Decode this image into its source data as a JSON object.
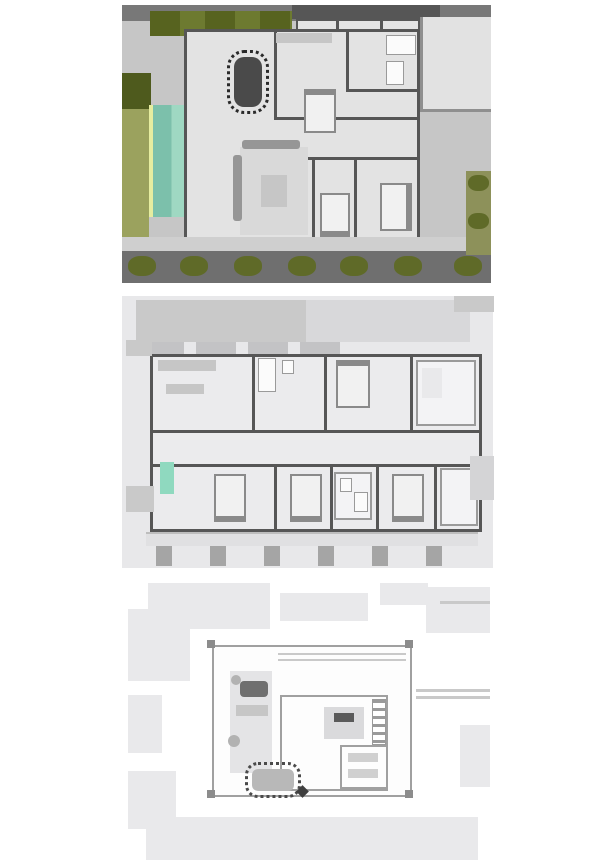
{
  "page": {
    "background": "#ffffff",
    "content_type": "architectural-floor-plan-sheet",
    "text_visible": ""
  },
  "plans": [
    {
      "id": "ground-floor-plan",
      "visible_elements": [
        "site-border-hedges",
        "lawn",
        "swimming-pool",
        "pool-deck",
        "dining-table-with-chairs",
        "kitchen-counter",
        "sofa-and-rug",
        "three-beds",
        "bathroom-fixtures",
        "entry-rooms",
        "driveway-court",
        "walkway",
        "shrub-row"
      ]
    },
    {
      "id": "first-floor-plan",
      "visible_elements": [
        "upper-terrace-band",
        "bedrooms-with-beds",
        "bathrooms",
        "corridor",
        "kitchenette",
        "balcony",
        "balcony-posts",
        "pool-glimpse-below"
      ]
    },
    {
      "id": "roof-plan",
      "visible_elements": [
        "parapet-shapes",
        "roof-terrace",
        "corner-posts",
        "planter-strip",
        "lounge-seating",
        "stair-bulkhead",
        "small-roof-room",
        "outdoor-dining-set"
      ]
    }
  ],
  "colors": {
    "site_gray": "#c6c6c6",
    "strip_top": "#787878",
    "strip_bottom": "#6f6f6f",
    "wall": "#565656",
    "floor": "#e3e3e3",
    "walkway": "#cfcfcf",
    "hedge_dark": "#57631f",
    "hedge_light": "#6d7a30",
    "lawn": "#9ba25e",
    "lawn_dark": "#4e5a1d",
    "pool": "#7cc0ab",
    "pool_light": "#9fd8c2",
    "pool_edge": "#e6eda0",
    "bush": "#5f6a28",
    "bush_light": "#8d915a",
    "counter": "#c6c6c6",
    "sofa": "#969696",
    "rug": "#d9d9d9",
    "bed": "#f1f1f1",
    "bed_edge": "#8a8a8a",
    "furn_dark": "#4a4a4a",
    "p2_bg": "#e8e8ea",
    "p2_band": "#c9c9c9",
    "p2_band_light": "#d8d8da",
    "p2_floor": "#ebebed",
    "p2_post": "#a5a5a5",
    "p2_balcony": "#e0e0e2",
    "p2_teal": "#8fd9bf",
    "p3_pale": "#e9e9eb",
    "p3_line": "#c9c9c9",
    "p3_border": "#a0a0a0",
    "p3_white": "#fdfdfd"
  }
}
